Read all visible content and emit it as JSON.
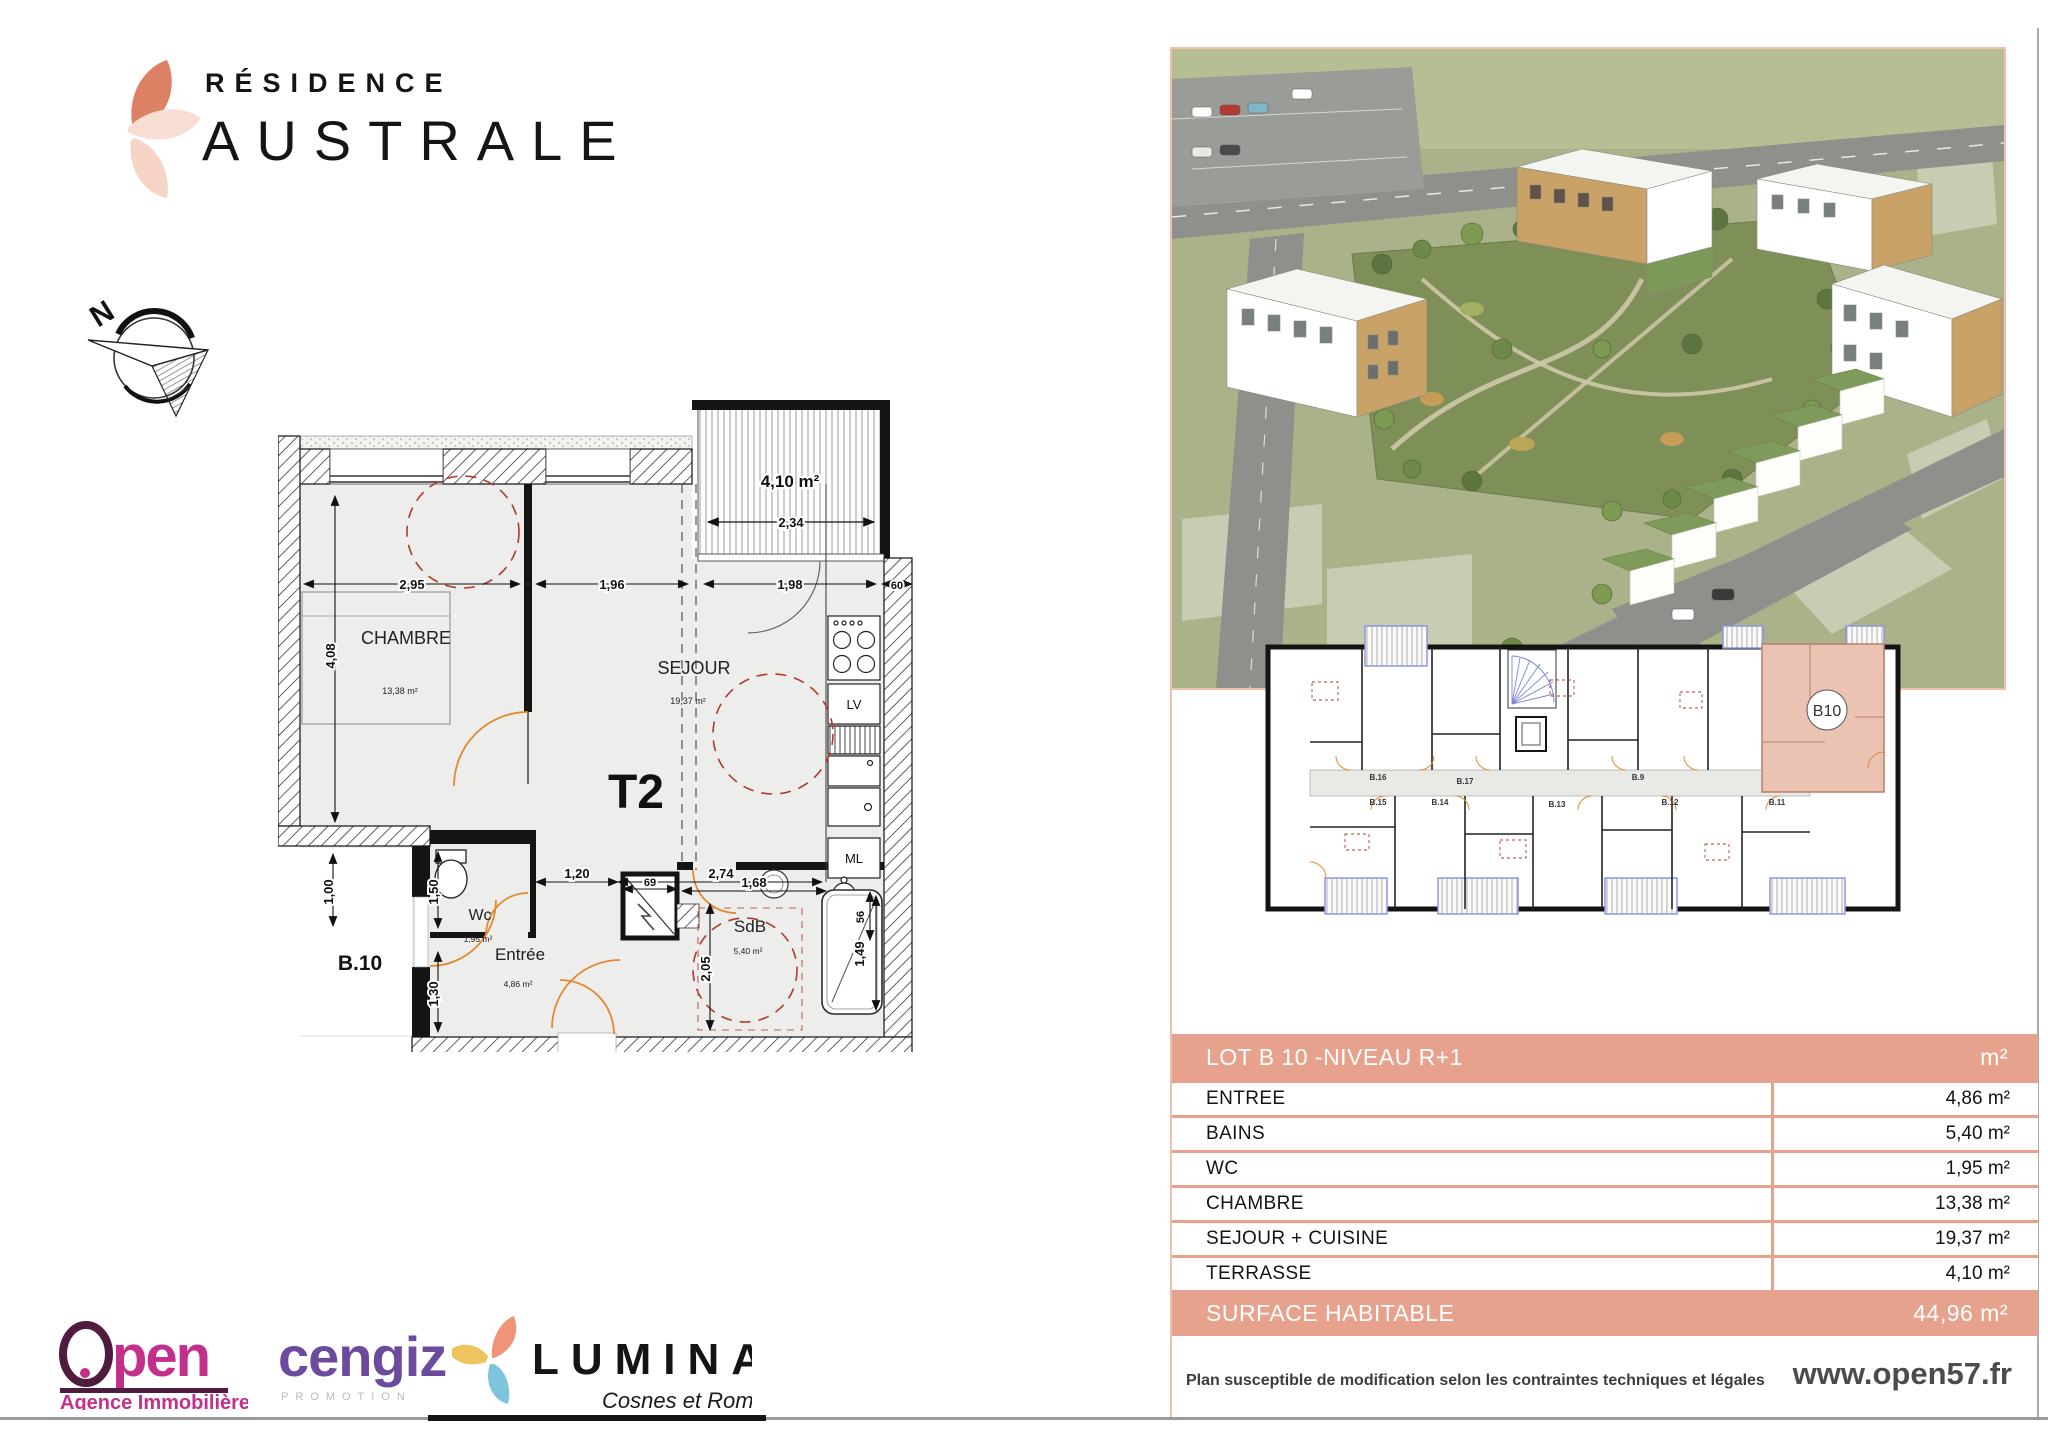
{
  "brand": {
    "residence": "RÉSIDENCE",
    "name": "AUSTRALE"
  },
  "compass": {
    "north": "N"
  },
  "plan": {
    "lot": "B.10",
    "type_label": "T2",
    "rooms": {
      "chambre": {
        "name": "CHAMBRE",
        "area": "13,38 m²"
      },
      "sejour": {
        "name": "SEJOUR",
        "area": "19,37 m²"
      },
      "wc": {
        "name": "Wc",
        "area": "1,95 m²"
      },
      "entree": {
        "name": "Entrée",
        "area": "4,86 m²"
      },
      "sdb": {
        "name": "SdB",
        "area": "5,40 m²"
      },
      "terrasse": {
        "area": "4,10 m²"
      }
    },
    "kitchen": {
      "dishwasher": "LV",
      "washer": "ML"
    },
    "dims": {
      "d295": "2,95",
      "d196": "1,96",
      "d198": "1,98",
      "d60": "60",
      "d234": "2,34",
      "d408": "4,08",
      "d100": "1,00",
      "d150": "1,50",
      "d130": "1,30",
      "d120": "1,20",
      "d274": "2,74",
      "d69": "69",
      "d168": "1,68",
      "d205": "2,05",
      "d56": "56",
      "d149": "1,49"
    }
  },
  "building_plan": {
    "highlight": "B10",
    "units": [
      "B.16",
      "B.17",
      "B.9",
      "B.15",
      "B.14",
      "B.13",
      "B.12",
      "B.11"
    ]
  },
  "area_table": {
    "header": {
      "title": "LOT B 10 -NIVEAU R+1",
      "unit": "m²"
    },
    "rows": [
      {
        "label": "ENTREE",
        "value": "4,86 m²"
      },
      {
        "label": "BAINS",
        "value": "5,40 m²"
      },
      {
        "label": "WC",
        "value": "1,95 m²"
      },
      {
        "label": "CHAMBRE",
        "value": "13,38 m²"
      },
      {
        "label": "SEJOUR + CUISINE",
        "value": "19,37 m²"
      },
      {
        "label": "TERRASSE",
        "value": "4,10 m²"
      }
    ],
    "footer": {
      "label": "SURFACE HABITABLE",
      "value": "44,96 m²"
    }
  },
  "footer": {
    "disclaimer": "Plan susceptible de modification selon les contraintes techniques et légales",
    "website": "www.open57.fr"
  },
  "partners": {
    "open": {
      "initial": "O",
      "rest": "pen",
      "tagline": "Agence Immobilière"
    },
    "cengiz": {
      "name": "cengiz",
      "tagline": "PROMOTION"
    },
    "lumina": {
      "name": "LUMINA",
      "tagline": "Cosnes et Romain"
    }
  },
  "colors": {
    "accent": "#e7a28e",
    "plan_highlight": "#eac3b2",
    "door_arc": "#e2892f",
    "furniture_dash": "#b23a2c"
  }
}
